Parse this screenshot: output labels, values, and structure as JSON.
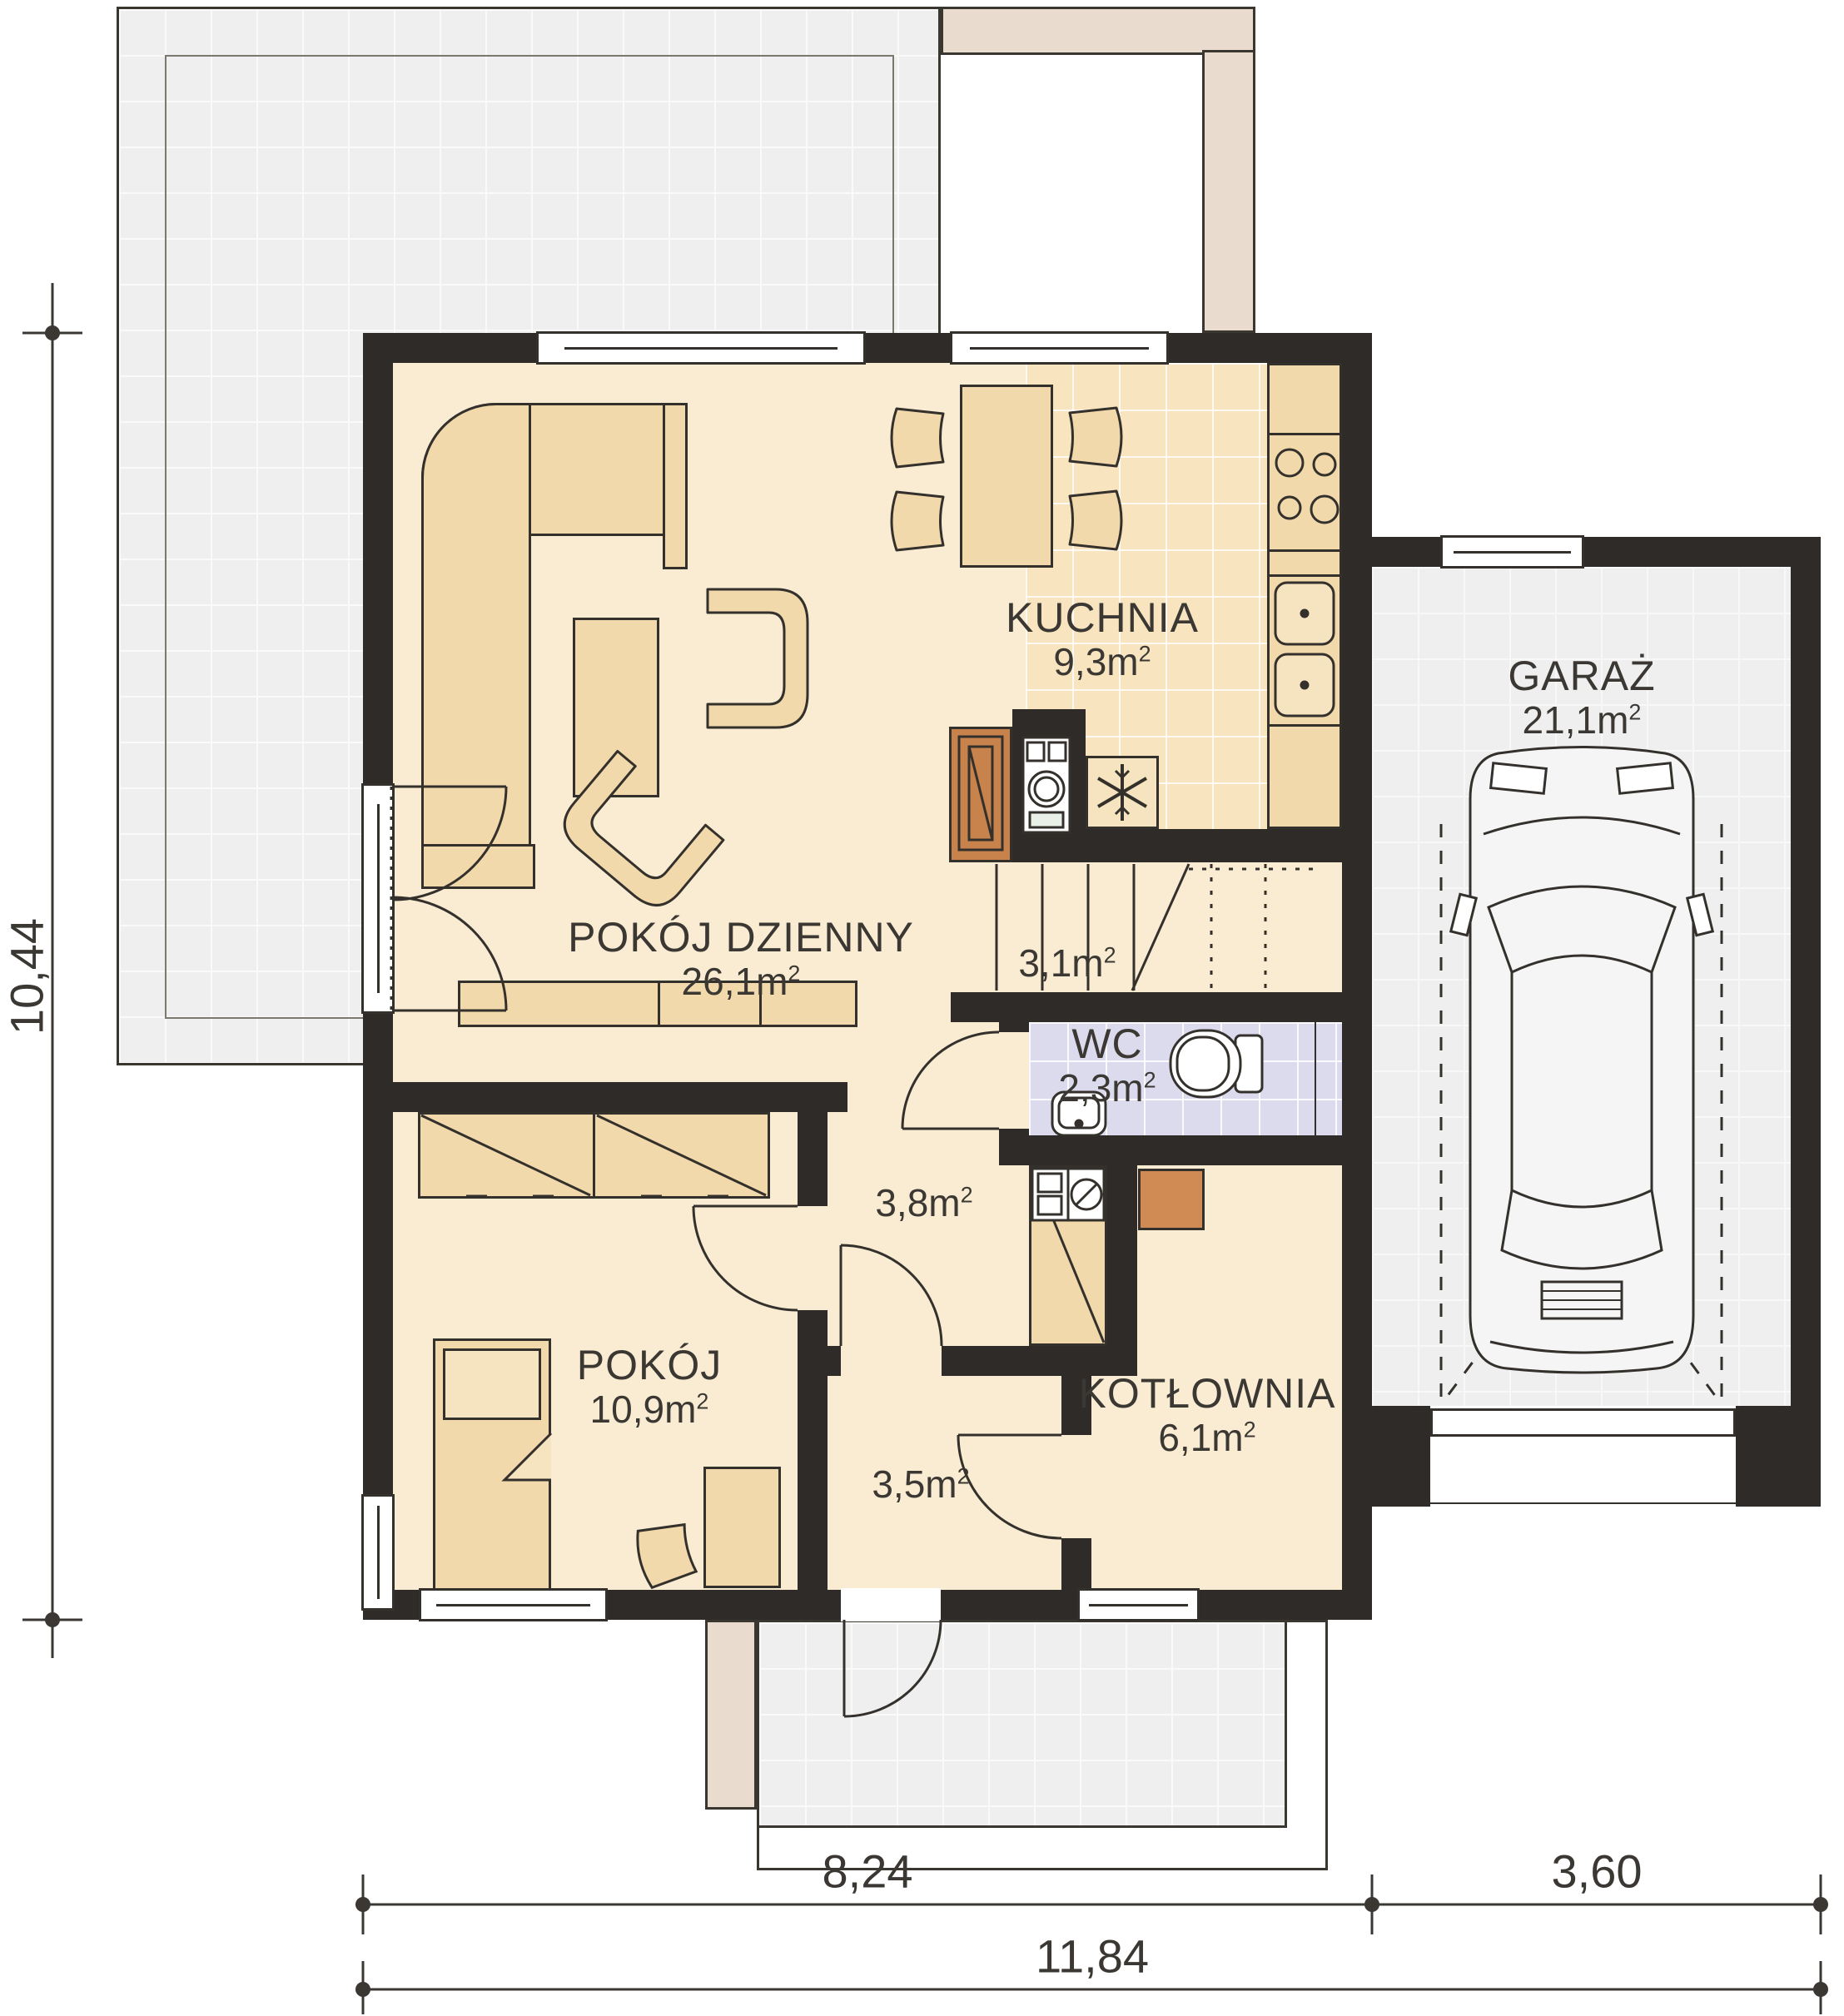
{
  "plan_title": "floor-plan-parter",
  "unit": "m",
  "sup": "2",
  "rooms": {
    "living": {
      "name": "POKÓJ DZIENNY",
      "area": "26,1"
    },
    "kitchen": {
      "name": "KUCHNIA",
      "area": "9,3"
    },
    "garage": {
      "name": "GARAŻ",
      "area": "21,1"
    },
    "stairs": {
      "name": "",
      "area": "3,1"
    },
    "wc": {
      "name": "WC",
      "area": "2,3"
    },
    "hall": {
      "name": "",
      "area": "3,8"
    },
    "bedroom": {
      "name": "POKÓJ",
      "area": "10,9"
    },
    "vestibule": {
      "name": "",
      "area": "3,5"
    },
    "boiler": {
      "name": "KOTŁOWNIA",
      "area": "6,1"
    }
  },
  "dimensions": {
    "height_left": "10,44",
    "width_main": "8,24",
    "width_garage": "3,60",
    "width_total": "11,84"
  },
  "icons": {
    "garage_car": "car-top-view",
    "wc_toilet": "toilet",
    "wc_basin": "washbasin",
    "kitchen_fridge": "snowflake",
    "kitchen_cooktop": "four-burners",
    "kitchen_sink": "double-sink",
    "utility_washer": "washing-machine",
    "living_fireplace": "fireplace",
    "stairs": "stair-treads"
  },
  "colors": {
    "wall": "#2e2b28",
    "floor": "#faecd2",
    "furniture": "#f2d9ab",
    "kitchen_tiles": "#f8e5c0",
    "wc_tiles": "#dcdbed",
    "terrace": "#f0eff0",
    "paving_band": "#e9dcce",
    "fireplace": "#c8834d",
    "hatch_orange": "#cf8b53",
    "text": "#3b3834"
  }
}
